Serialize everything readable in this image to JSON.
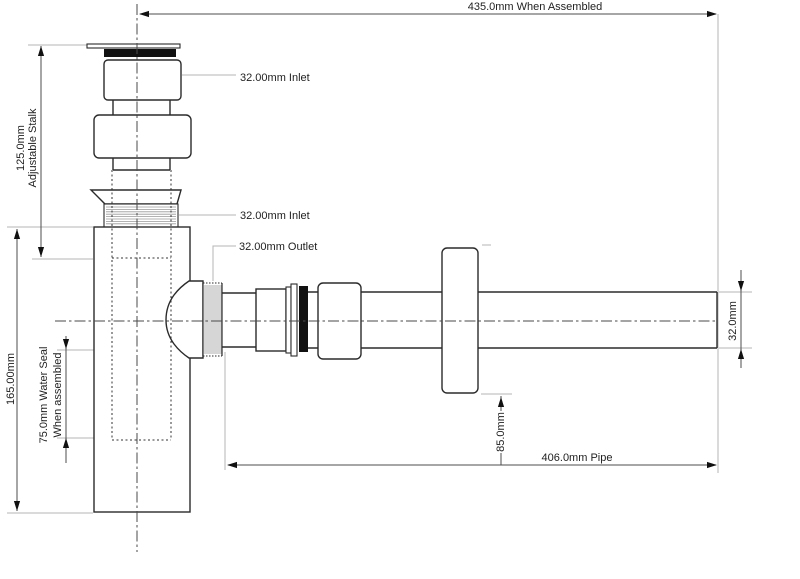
{
  "labels": {
    "assembled_width": "435.0mm When Assembled",
    "inlet_top": "32.00mm Inlet",
    "inlet_lower": "32.00mm Inlet",
    "outlet": "32.00mm Outlet",
    "stalk_length": "125.0mm",
    "stalk_name": "Adjustable Stalk",
    "body_height": "165.00mm",
    "water_seal_line1": "75.0mm Water Seal",
    "water_seal_line2": "When assembled",
    "pipe_diameter": "32.0mm",
    "flange_diameter": "85.0mm",
    "pipe_length": "406.0mm Pipe"
  },
  "colors": {
    "background": "#ffffff",
    "outline": "#2b2b2b",
    "dimension": "#4d4d4d",
    "extension": "#b5b5b5",
    "arrow": "#111111",
    "seal": "#111111",
    "thread": "#999999",
    "centerline": "#4a4a4a",
    "text": "#1f1f1f"
  }
}
